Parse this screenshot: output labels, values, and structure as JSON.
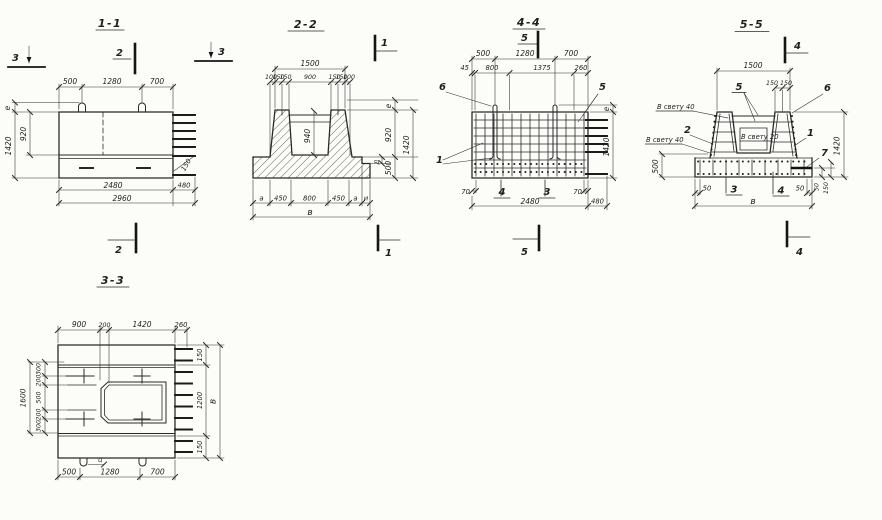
{
  "meta": {
    "paper": "#fcfcf9",
    "ink": "#2a2a2a"
  },
  "s11": {
    "title": "1-1",
    "mk_left": "3",
    "mk_top": "2",
    "mk_right": "3",
    "mk_bottom": "2",
    "top": [
      "500",
      "1280",
      "700"
    ],
    "e": "е",
    "h920": "920",
    "h1420": "1420",
    "r150": "150",
    "b2480": "2480",
    "b480": "480",
    "b2960": "2960"
  },
  "s22": {
    "title": "2-2",
    "mk_top": "1",
    "mk_bottom": "1",
    "w1500": "1500",
    "row": [
      "100",
      "150",
      "150",
      "900",
      "150",
      "150",
      "100"
    ],
    "d940": "940",
    "e": "е",
    "h920": "920",
    "h1420": "1420",
    "h500": "500",
    "dd": "д",
    "bottom": [
      "а",
      "450",
      "800",
      "450",
      "а",
      "и"
    ],
    "v": "в"
  },
  "s44": {
    "title": "4-4",
    "mk_top": "5",
    "mk_bottom": "5",
    "top": [
      "500",
      "1280",
      "700"
    ],
    "row": [
      "45",
      "800",
      "1375",
      "260"
    ],
    "c6": "6",
    "c5": "5",
    "c1": "1",
    "e": "е",
    "h1420": "1420",
    "d70a": "70",
    "c4": "4",
    "c3": "3",
    "d70b": "70",
    "b2480": "2480",
    "b480": "480"
  },
  "s55": {
    "title": "5-5",
    "mk_top": "4",
    "mk_bottom": "4",
    "w1500": "1500",
    "t150a": "150",
    "t150b": "150",
    "c5": "5",
    "c6": "6",
    "c2": "2",
    "c1": "1",
    "c7": "7",
    "clear40a": "В свету 40",
    "clear40b": "В свету 40",
    "clear20": "В свету 20",
    "h500": "500",
    "h1420": "1420",
    "r50": "50",
    "r150": "150",
    "b50a": "50",
    "c3": "3",
    "c4": "4",
    "b50b": "50",
    "v": "в"
  },
  "s33": {
    "title": "3-3",
    "top": [
      "900",
      "200",
      "1420",
      "260"
    ],
    "h1600": "1600",
    "col": [
      "300",
      "200",
      "500",
      "200",
      "300"
    ],
    "r150a": "150",
    "r1200": "1200",
    "r150b": "150",
    "v": "в",
    "bottom": [
      "500",
      "1280",
      "700"
    ],
    "tc": "ц"
  }
}
